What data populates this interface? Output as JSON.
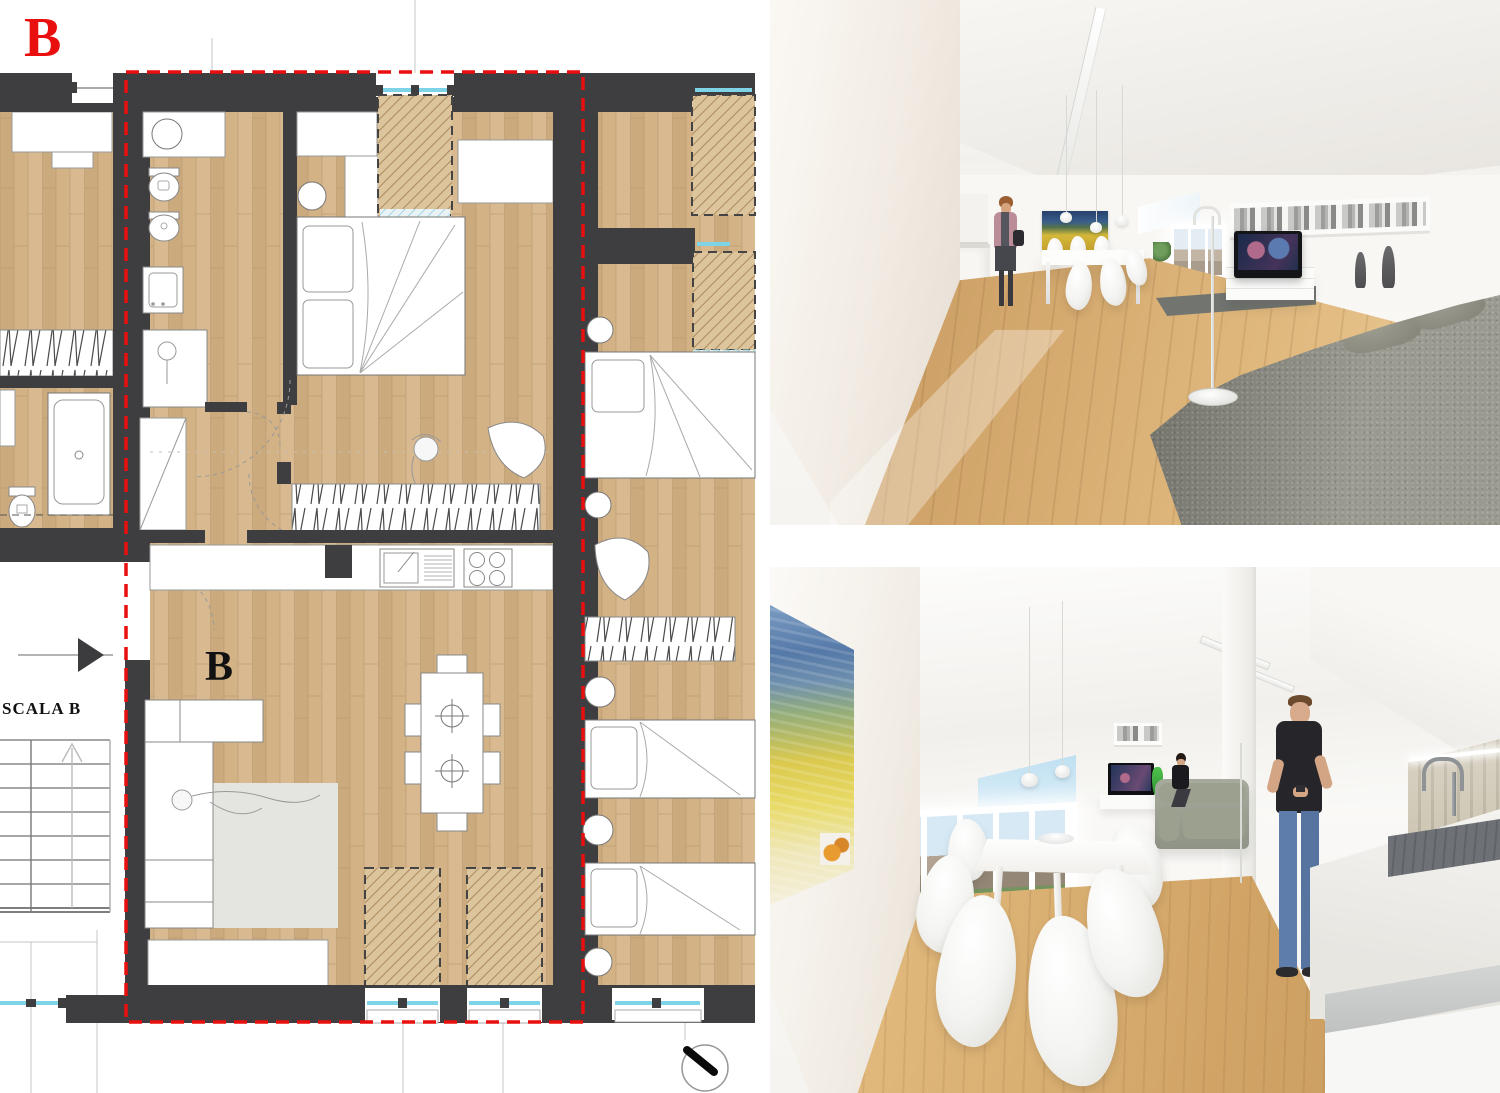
{
  "plan": {
    "sheet_label": "B",
    "unit_label": "B",
    "stair_label": "SCALA B"
  },
  "icons": {
    "north_arrow": "north-arrow",
    "entrance_arrow": "entrance-arrow"
  },
  "colors": {
    "boundary-red": "#e90f0f",
    "wall-dark": "#3e3e40",
    "wood-plan": "#d3b286",
    "glazing-cyan": "#7fd3e6",
    "rug-gray": "#e4e4e1",
    "sofa-gray": "#8c8c82",
    "vase-green": "#3db03d",
    "sky-blue": "#cfe6f4",
    "render-wood": "#d4a76a"
  }
}
